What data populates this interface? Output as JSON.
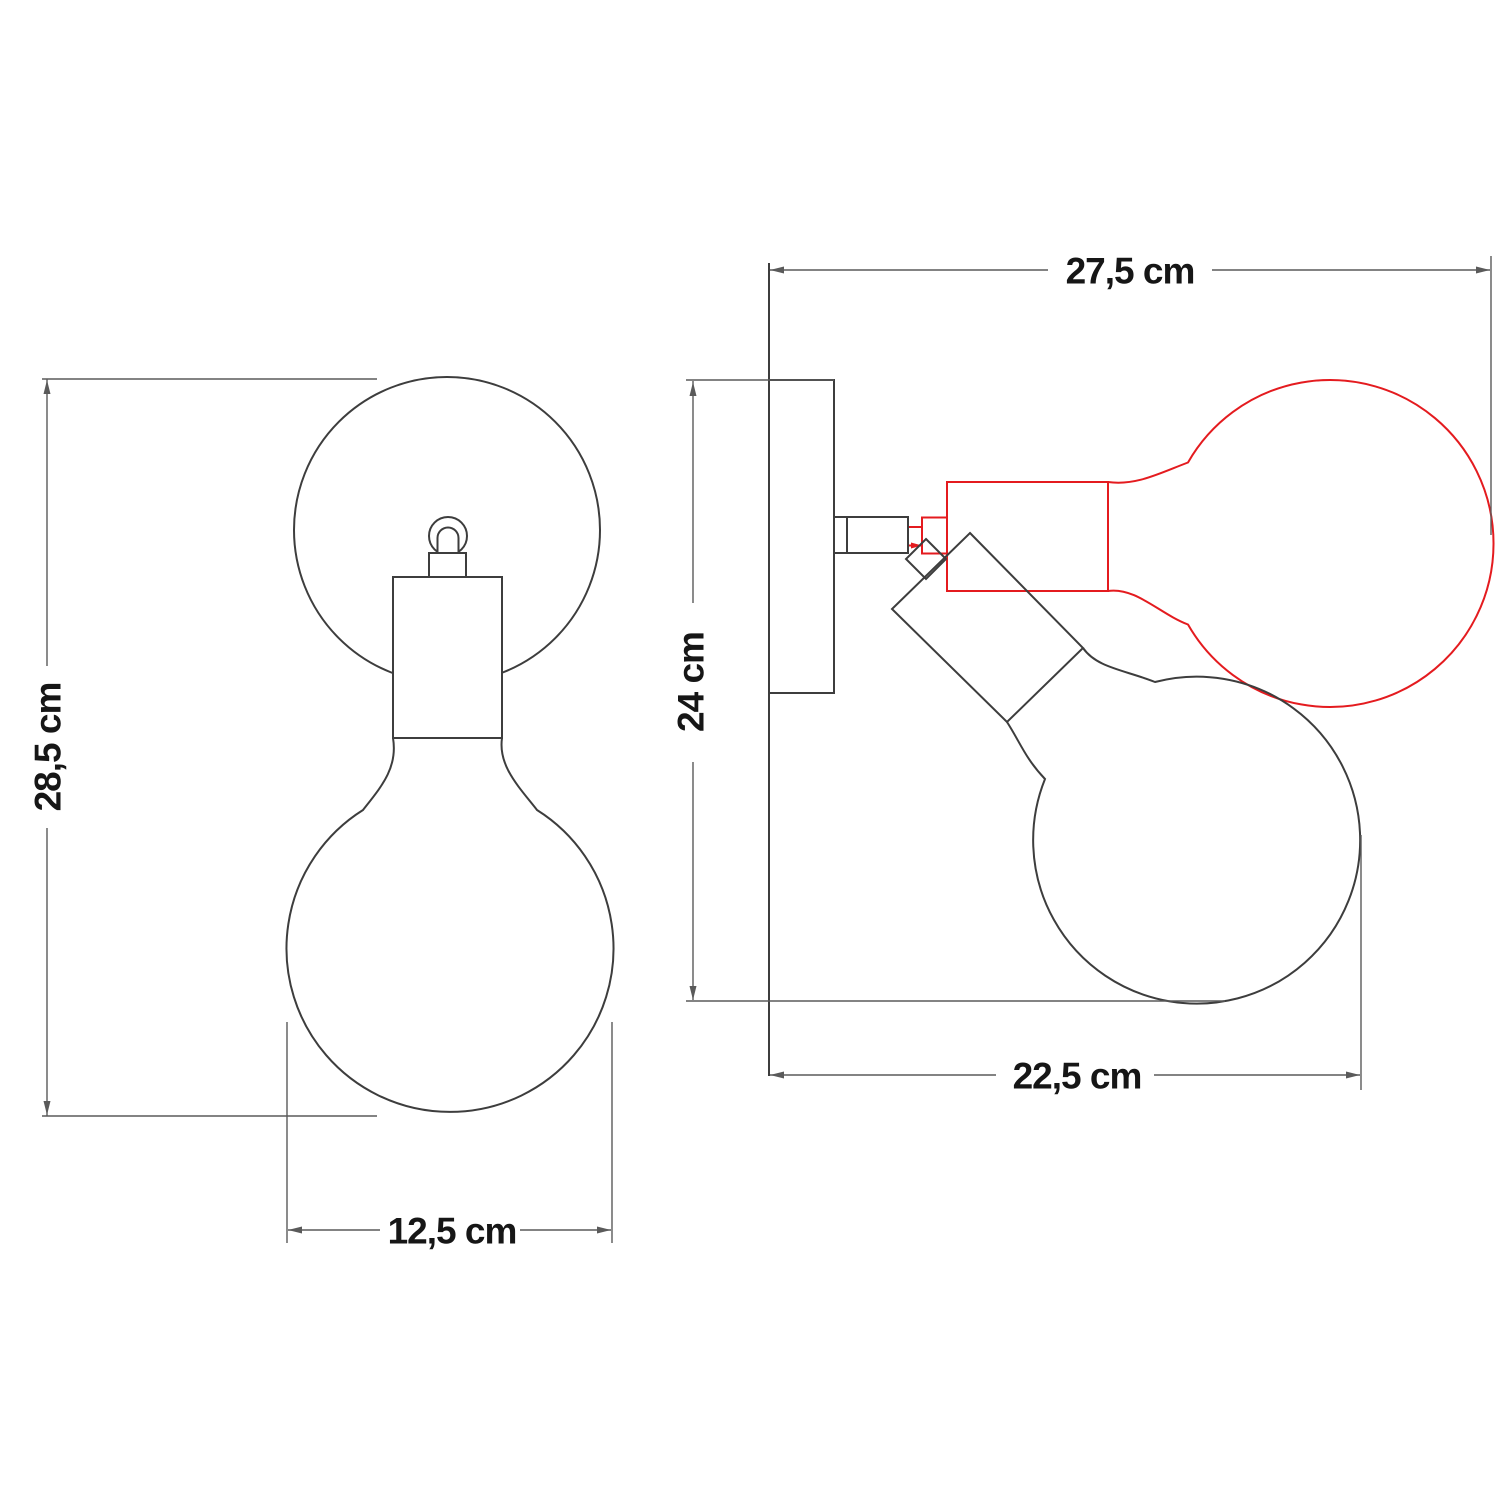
{
  "diagram": {
    "type": "technical-dimension-drawing",
    "subject": "adjustable wall lamp with globe bulb, front and side views, red alternate bulb position",
    "colors": {
      "outline": "#3d3d3d",
      "dimension": "#5a5a5a",
      "text": "#161616",
      "alt_position": "#e41b1f",
      "background": "#ffffff"
    },
    "dimensions": {
      "front_height": {
        "label": "28,5 cm"
      },
      "front_width": {
        "label": "12,5 cm"
      },
      "side_width": {
        "label": "27,5 cm"
      },
      "side_height": {
        "label": "24 cm"
      },
      "side_depth": {
        "label": "22,5 cm"
      }
    }
  }
}
